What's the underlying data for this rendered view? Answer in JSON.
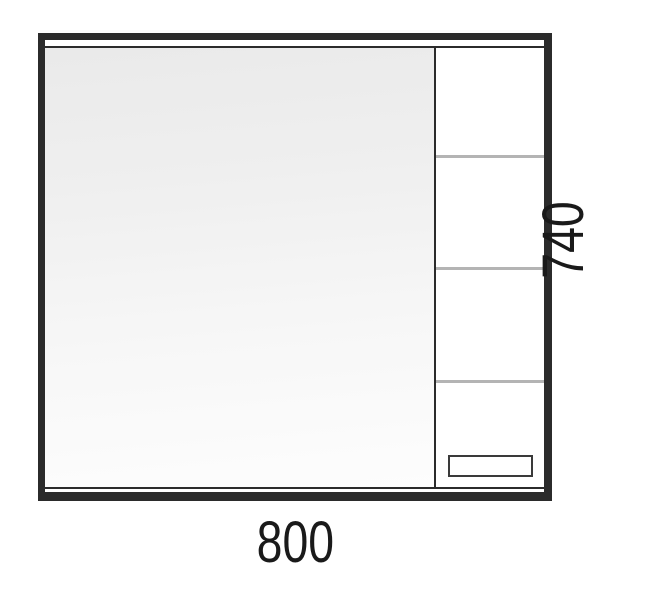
{
  "cabinet": {
    "width_dimension": "800",
    "height_dimension": "740",
    "shelf_line_count": 3,
    "has_mirror_panel": true,
    "has_handle": true
  },
  "colors": {
    "frame": "#2b2b2b",
    "divider": "#2b2b2b",
    "shelf_line": "#b4b4b4",
    "handle_outline": "#3a3a3a",
    "mirror_gradient_top": "#eaeaea",
    "mirror_gradient_bottom": "#fdfdfd",
    "label_text": "#1a1a1a",
    "background": "#ffffff"
  }
}
